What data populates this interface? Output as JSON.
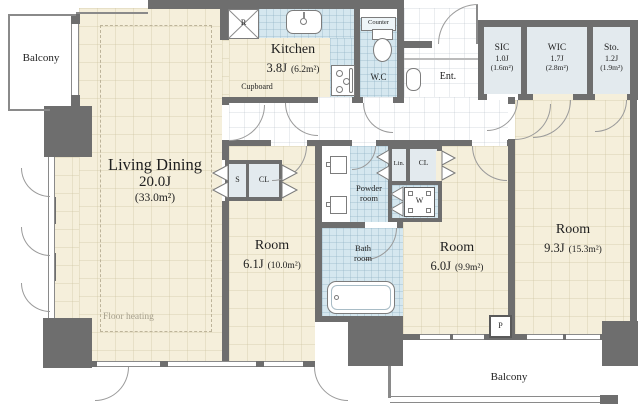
{
  "colors": {
    "wall": "#6e6e6e",
    "floor_cream": "#f5efdb",
    "wet_floor_blue": "#d5e7ef",
    "closet_fill": "#e3eaee",
    "line_gray": "#8a8a8a",
    "text": "#1f1f1f",
    "floor_heating_text": "#a59f8c"
  },
  "plan": {
    "balcony_top": {
      "label": "Balcony"
    },
    "balcony_bottom": {
      "label": "Balcony"
    },
    "living": {
      "name": "Living Dining",
      "size": "20.0J",
      "area": "(33.0m²)"
    },
    "kitchen": {
      "name": "Kitchen",
      "size": "3.8J",
      "area": "(6.2m²)"
    },
    "cupboard": {
      "label": "Cupboard"
    },
    "wc": {
      "label": "W.C",
      "counter": "Counter"
    },
    "entrance": {
      "label": "Ent."
    },
    "sic": {
      "name": "SIC",
      "size": "1.0J",
      "area": "(1.6m²)"
    },
    "wic": {
      "name": "WIC",
      "size": "1.7J",
      "area": "(2.8m²)"
    },
    "sto": {
      "name": "Sto.",
      "size": "1.2J",
      "area": "(1.9m²)"
    },
    "room_6_1": {
      "name": "Room",
      "size": "6.1J",
      "area": "(10.0m²)"
    },
    "room_6_0": {
      "name": "Room",
      "size": "6.0J",
      "area": "(9.9m²)"
    },
    "room_9_3": {
      "name": "Room",
      "size": "9.3J",
      "area": "(15.3m²)"
    },
    "powder_room": {
      "line1": "Powder",
      "line2": "room"
    },
    "bath_room": {
      "line1": "Bath",
      "line2": "room"
    },
    "floor_heating": {
      "label": "Floor heating"
    },
    "closets": {
      "shelf": "S",
      "closet_6_1": "CL",
      "linen": "Lin.",
      "closet_hall": "CL",
      "washer": "W",
      "refrigerator": "R",
      "pipe_space": "P"
    }
  }
}
